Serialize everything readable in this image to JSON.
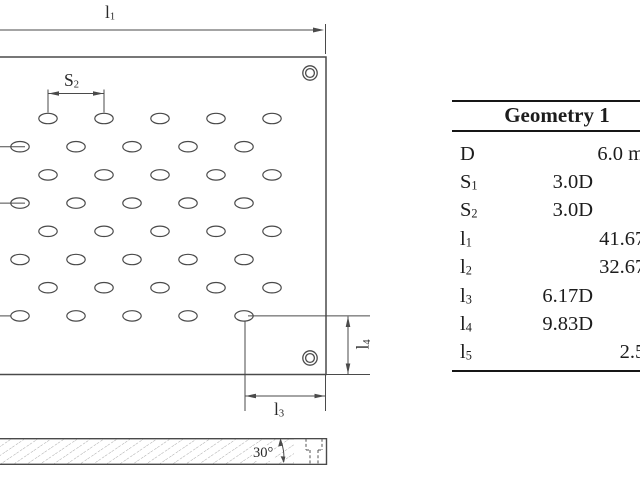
{
  "colors": {
    "background": "#ffffff",
    "line": "#4a4a4a",
    "text": "#1c1c1c"
  },
  "diagram": {
    "labels": {
      "l1": {
        "base": "l",
        "sub": "1"
      },
      "s2": {
        "base": "S",
        "sub": "2"
      },
      "l3": {
        "base": "l",
        "sub": "3"
      },
      "l4": {
        "base": "l",
        "sub": "4"
      },
      "angle": "30°"
    },
    "hole_pattern": {
      "rows": 8,
      "row_start_y": 118.5,
      "row_pitch": 28.2,
      "xs_odd": [
        48,
        104,
        160,
        216,
        272
      ],
      "xs_even": [
        20,
        76,
        132,
        188,
        244
      ],
      "hole_rx": 9.2,
      "hole_ry": 5.2
    },
    "mount_holes": [
      {
        "cx": 310,
        "cy": 73
      },
      {
        "cx": 310,
        "cy": 358
      }
    ]
  },
  "table": {
    "title": "Geometry 1",
    "rows": [
      {
        "sym": "D",
        "sub": "",
        "rel": "",
        "abs": "6.0 mm"
      },
      {
        "sym": "S",
        "sub": "1",
        "rel": "3.0D",
        "abs": ""
      },
      {
        "sym": "S",
        "sub": "2",
        "rel": "3.0D",
        "abs": ""
      },
      {
        "sym": "l",
        "sub": "1",
        "rel": "",
        "abs": "41.67D"
      },
      {
        "sym": "l",
        "sub": "2",
        "rel": "",
        "abs": "32.67D"
      },
      {
        "sym": "l",
        "sub": "3",
        "rel": "6.17D",
        "abs": ""
      },
      {
        "sym": "l",
        "sub": "4",
        "rel": "9.83D",
        "abs": ""
      },
      {
        "sym": "l",
        "sub": "5",
        "rel": "",
        "abs": "2.5D"
      }
    ]
  }
}
